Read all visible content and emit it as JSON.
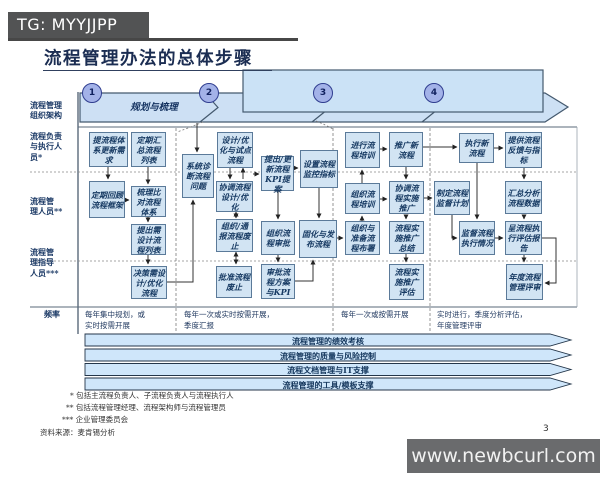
{
  "badge": {
    "text": "TG: MYYJJPP"
  },
  "title": "流程管理办法的总体步骤",
  "band": {
    "steps": [
      "1",
      "2",
      "3",
      "4"
    ],
    "step1_label": "规划与梳理"
  },
  "row_labels": {
    "r1": "流程管理\n组织架构",
    "r2": "流程负责\n与执行人\n员*",
    "r3": "流程管\n理人员**",
    "r4": "流程管\n理指导\n人员***",
    "freq": "频率"
  },
  "boxes": {
    "b1": "提流程体系更新需求",
    "b2": "定期汇总流程列表",
    "b3": "定期回顾流程框架",
    "b4": "梳理比对流程体系",
    "b5": "提出需设计流程列表",
    "b6": "决策需设计/优化流程",
    "b7": "系统诊断流程问题",
    "b8": "设计/优化与试点流程",
    "b9": "协调流程设计/优化",
    "b10": "组织/通报流程废止",
    "b11": "批准流程废止",
    "b12": "提出/更新流程KPI提案",
    "b13": "组织流程审批",
    "b14": "审批流程方案与KPI",
    "b15": "设置流程监控指标",
    "b16": "固化与发布流程",
    "b17": "进行流程培训",
    "b18": "推广新流程",
    "b19": "组织流程培训",
    "b20": "协调流程实施推广",
    "b21": "组织与准备流程布署",
    "b22": "流程实施推广总结",
    "b23": "流程实施推广评估",
    "b24": "执行新流程",
    "b25": "提供流程反馈与指标",
    "b26": "制定流程监督计划",
    "b27": "汇总分析流程数据",
    "b28": "监督流程执行情况",
    "b29": "呈流程执行评估报告",
    "b30": "年度流程管理评审"
  },
  "frequency": {
    "f1": "每年集中规划，或\n实时按需开展",
    "f2": "每年一次或实时按需开展，\n季度汇报",
    "f3": "每年一次或按需开展",
    "f4": "实时进行，季度分析评估，\n年度管理评审"
  },
  "bars": [
    "流程管理的绩效考核",
    "流程管理的质量与风险控制",
    "流程文档管理与IT支撑",
    "流程管理的工具/模板支撑"
  ],
  "footnotes": [
    "* 包括主流程负责人、子流程负责人与流程执行人",
    "** 包括流程管理经理、流程架构师与流程管理员",
    "*** 企业管理委员会"
  ],
  "source": "资料来源：麦肯锡分析",
  "page_number": "3",
  "watermark": "www.newbcurl.com",
  "colors": {
    "band_fill": "#cde0f4",
    "band_edge": "#44596e",
    "box_fill": "#d2e4f3",
    "box_edge": "#5b7a99",
    "circle_fill": "#a3b2e8",
    "circle_edge": "#2f3d8f",
    "bar_fill": "#cfe6fa",
    "badge_bg": "#525354",
    "watermark_bg": "#6a6b6d",
    "text_ink": "#1c3a66"
  }
}
